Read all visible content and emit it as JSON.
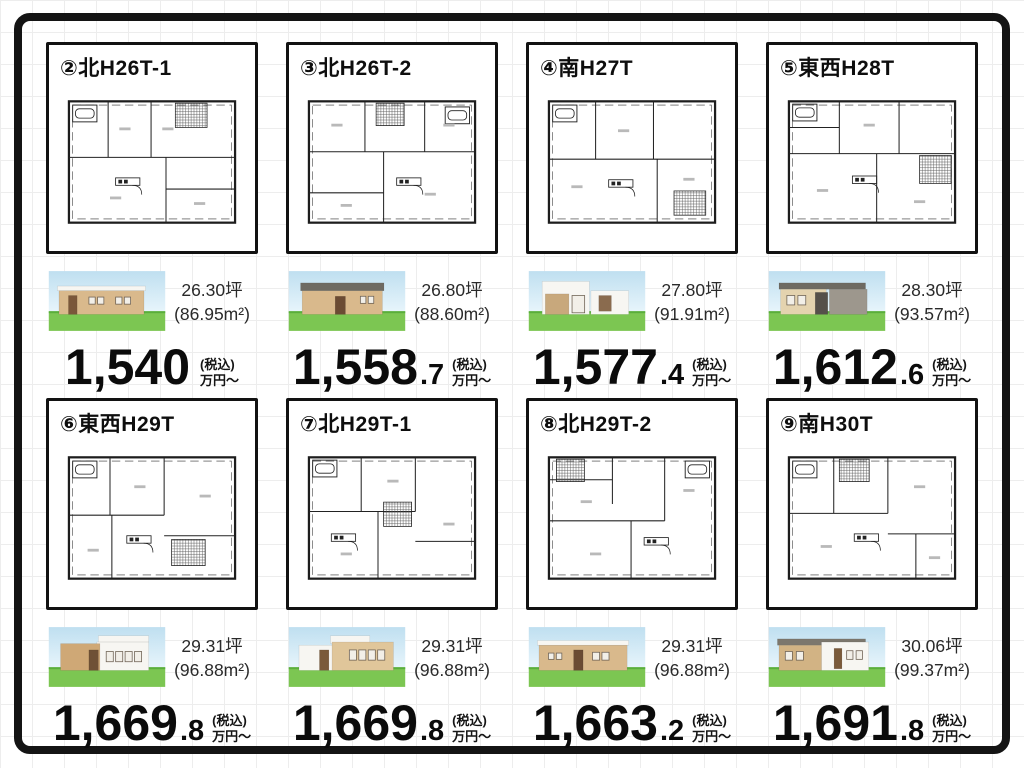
{
  "price_suffix": {
    "tax": "(税込)",
    "unit": "万円〜"
  },
  "theme": {
    "frame": "#141414",
    "grid_line": "#ededed",
    "text": "#111111",
    "sky_top": "#bfdff0",
    "sky_bottom": "#eef8fd",
    "grass": "#7cc652",
    "grass_edge": "#5aae3c",
    "plan_line": "#1d1d1d"
  },
  "plans": [
    {
      "title": "②北H26T-1",
      "area_tsubo": "26.30坪",
      "area_m2": "(86.95m²)",
      "price_int": "1,540",
      "price_frac": "",
      "house": {
        "wall": "#d9b98c",
        "roof": "#f3f1ea",
        "accent": "#7a573a"
      }
    },
    {
      "title": "③北H26T-2",
      "area_tsubo": "26.80坪",
      "area_m2": "(88.60m²)",
      "price_int": "1,558",
      "price_frac": ".7",
      "house": {
        "wall": "#d9b98c",
        "roof": "#6e6a62",
        "accent": "#6b4b33"
      }
    },
    {
      "title": "④南H27T",
      "area_tsubo": "27.80坪",
      "area_m2": "(91.91m²)",
      "price_int": "1,577",
      "price_frac": ".4",
      "house": {
        "wall": "#c8a87c",
        "roof": "#f3f1ea",
        "accent": "#8a6b4e"
      }
    },
    {
      "title": "⑤東西H28T",
      "area_tsubo": "28.30坪",
      "area_m2": "(93.57m²)",
      "price_int": "1,612",
      "price_frac": ".6",
      "house": {
        "wall": "#e4d3af",
        "roof": "#6e6a62",
        "accent": "#4c473f"
      }
    },
    {
      "title": "⑥東西H29T",
      "area_tsubo": "29.31坪",
      "area_m2": "(96.88m²)",
      "price_int": "1,669",
      "price_frac": ".8",
      "house": {
        "wall": "#cfa876",
        "roof": "#f3f1ea",
        "accent": "#6f5136"
      }
    },
    {
      "title": "⑦北H29T-1",
      "area_tsubo": "29.31坪",
      "area_m2": "(96.88m²)",
      "price_int": "1,669",
      "price_frac": ".8",
      "house": {
        "wall": "#e0c69a",
        "roof": "#f3f1ea",
        "accent": "#7a5a3a"
      }
    },
    {
      "title": "⑧北H29T-2",
      "area_tsubo": "29.31坪",
      "area_m2": "(96.88m²)",
      "price_int": "1,663",
      "price_frac": ".2",
      "house": {
        "wall": "#d9b98c",
        "roof": "#f3f1ea",
        "accent": "#6b4b33"
      }
    },
    {
      "title": "⑨南H30T",
      "area_tsubo": "30.06坪",
      "area_m2": "(99.37m²)",
      "price_int": "1,691",
      "price_frac": ".8",
      "house": {
        "wall": "#d2b384",
        "roof": "#7c776d",
        "accent": "#7a5a3a"
      }
    }
  ]
}
